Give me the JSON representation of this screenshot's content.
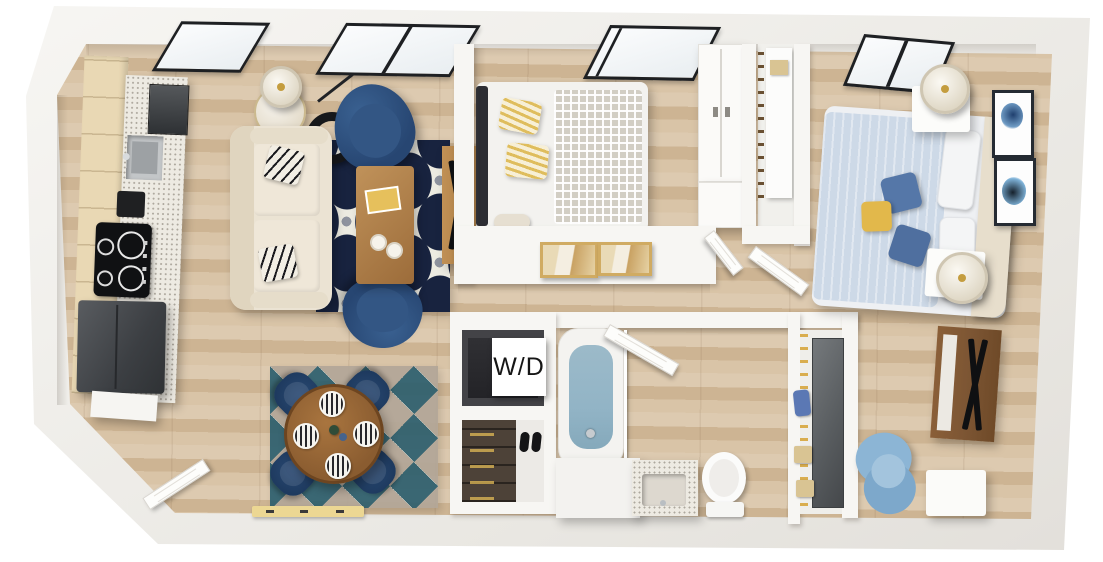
{
  "meta": {
    "type": "3d-floorplan-render",
    "view": "top-down"
  },
  "labels": {
    "washer_dryer": "W/D"
  },
  "colors": {
    "wall": "#f7f6f3",
    "frame_black": "#1e2023",
    "glass": "#e9eef1",
    "navy_rug": "#18233f",
    "rug_cream": "#ecebe1",
    "rug_gray": "#8e939e",
    "teal": "#2d5f6e",
    "warm_gray": "#b2a698",
    "sofa": "#ebe3d3",
    "armchair": "#3a6191",
    "dining_chair": "#2a4a74",
    "table_wood": "#8a5c30",
    "coffee_table": "#c0925a",
    "console_dark": "#7c5533",
    "blanket_gray": "#d2cec4",
    "pillow_yellow": "#dfbd5d",
    "bed2_duvet": "#cdd9e7",
    "headboard_cream": "#e7decc",
    "accent_blue": "#5577a8",
    "accent_yellow": "#e2b84b",
    "tub_water": "#92b4c6",
    "chair_blue": "#8cb5d5",
    "appliance": "#3c3f43",
    "cabinet": "#e9d8b4",
    "counter": "#edeae2",
    "closet_door_dark": "#595d60",
    "box_tan": "#d9c493",
    "bag_blue": "#5b78b4",
    "art_tan": "#d0ab62"
  },
  "rooms": [
    {
      "name": "kitchen",
      "items": [
        "upper-cabinets",
        "counter",
        "sink",
        "wall-oven",
        "coffee-maker",
        "cooktop",
        "refrigerator"
      ]
    },
    {
      "name": "living-room",
      "items": [
        "sofa",
        "throw-pillows",
        "armchair-top",
        "armchair-bottom",
        "side-table",
        "table-lamp",
        "floor-lamp",
        "area-rug",
        "coffee-table",
        "magazines",
        "cups",
        "tv-console",
        "tv"
      ]
    },
    {
      "name": "dining-area",
      "items": [
        "round-table",
        "dining-chairs",
        "place-settings",
        "area-rug",
        "entry-bench",
        "entry-door"
      ]
    },
    {
      "name": "bedroom-1",
      "items": [
        "bed",
        "striped-pillows",
        "patterned-blanket",
        "wardrobe",
        "window",
        "wall-art"
      ]
    },
    {
      "name": "hallway",
      "items": [
        "framed-prints",
        "linen-closet",
        "open-doors"
      ]
    },
    {
      "name": "laundry-closet",
      "items": [
        "washer-dryer",
        "label-card"
      ]
    },
    {
      "name": "entry-closet",
      "items": [
        "shoe-shelves",
        "slippers"
      ]
    },
    {
      "name": "bathroom",
      "items": [
        "bathtub",
        "vanity-sink",
        "toilet",
        "open-door"
      ]
    },
    {
      "name": "walk-in-closet",
      "items": [
        "hanging-clothes",
        "sliding-door",
        "storage-boxes",
        "bag"
      ]
    },
    {
      "name": "bedroom-2",
      "items": [
        "bed",
        "accent-pillows",
        "nightstands",
        "table-lamps",
        "wall-art",
        "media-console",
        "tv",
        "desk-chair",
        "side-table",
        "window"
      ]
    }
  ]
}
